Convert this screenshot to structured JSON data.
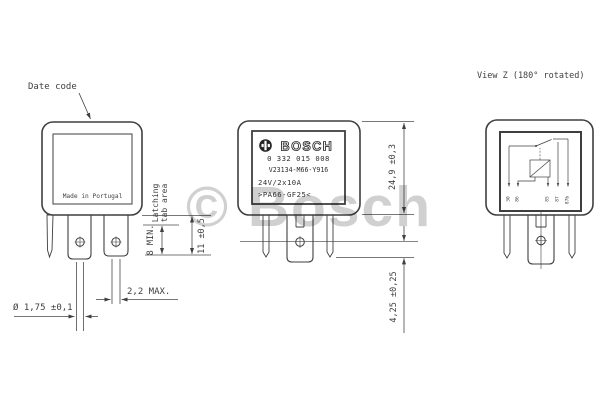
{
  "annotations": {
    "date_code": "Date code",
    "made_in": "Made in Portugal",
    "latching_line1": "Latching",
    "latching_line2": "tab area",
    "view_z_title": "View Z (180° rotated)",
    "watermark": "© Bosch"
  },
  "dimensions": {
    "hole_diameter": "Ø 1,75 ±0,1",
    "tab_thickness": "2,2 MAX.",
    "latch_min": "8 MIN.",
    "pin_length": "11 ±0,5",
    "body_height": "24,9 ±0,3",
    "tip_offset": "4,25 ±0,25"
  },
  "label": {
    "brand": "BOSCH",
    "part_number": "0 332 015 008",
    "type_code": "V23134-M66-Y916",
    "rating": "24V/2x10A",
    "material": ">PA66-GF25<"
  },
  "view_z": {
    "pins": [
      "30",
      "86",
      "85",
      "87",
      "87b"
    ]
  },
  "colors": {
    "line": "#3f3f3f",
    "watermark_gray": "#a9a9a9"
  }
}
